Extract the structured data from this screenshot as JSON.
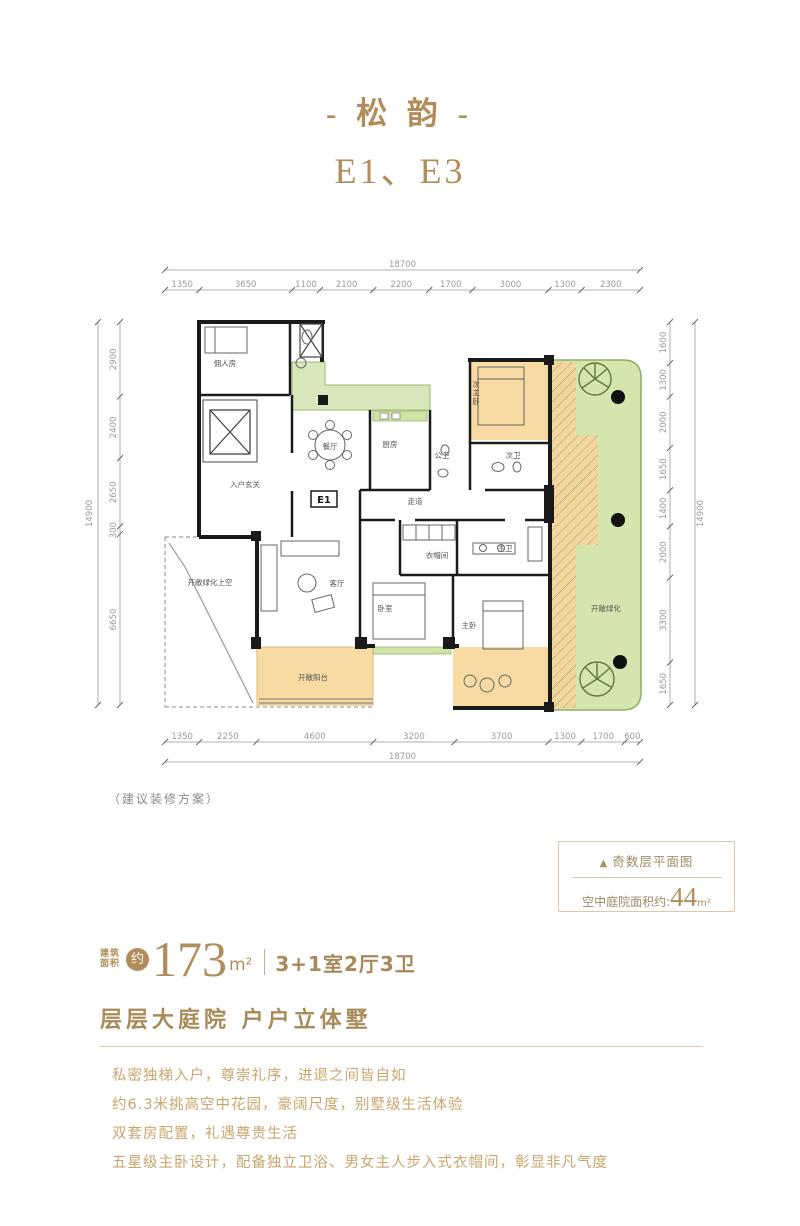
{
  "title": "- 松 韵 -",
  "subtitle": "E1、E3",
  "plan": {
    "unit_label": "E1",
    "note": "（建议装修方案）",
    "rooms": [
      {
        "label": "佣人房",
        "x": 140,
        "y": 121
      },
      {
        "label": "入户玄关",
        "x": 160,
        "y": 242
      },
      {
        "label": "餐厅",
        "x": 245,
        "y": 204
      },
      {
        "label": "厨房",
        "x": 305,
        "y": 202
      },
      {
        "label": "公卫",
        "x": 357,
        "y": 213
      },
      {
        "label": "走道",
        "x": 330,
        "y": 259
      },
      {
        "label": "次主卧",
        "x": 391,
        "y": 142,
        "v": true
      },
      {
        "label": "次卫",
        "x": 428,
        "y": 213
      },
      {
        "label": "主卫",
        "x": 420,
        "y": 306
      },
      {
        "label": "衣帽间",
        "x": 352,
        "y": 313
      },
      {
        "label": "卧室",
        "x": 300,
        "y": 366
      },
      {
        "label": "主卧",
        "x": 384,
        "y": 383
      },
      {
        "label": "客厅",
        "x": 252,
        "y": 341
      },
      {
        "label": "开敞绿化上空",
        "x": 125,
        "y": 340
      },
      {
        "label": "开敞阳台",
        "x": 228,
        "y": 435
      },
      {
        "label": "开敞绿化",
        "x": 521,
        "y": 366
      }
    ],
    "dims": {
      "top": {
        "total": "18700",
        "segments": [
          "1350",
          "3650",
          "1100",
          "2100",
          "2200",
          "1700",
          "3000",
          "1300",
          "2300"
        ]
      },
      "bottom": {
        "total": "18700",
        "segments": [
          "1350",
          "2250",
          "4600",
          "3200",
          "3700",
          "1300",
          "1700",
          "600"
        ]
      },
      "left": {
        "total": "14900",
        "segments": [
          "2900",
          "2400",
          "2650",
          "300",
          "6650"
        ]
      },
      "right": {
        "total": "14900",
        "segments": [
          "1600",
          "1300",
          "2000",
          "1650",
          "1400",
          "2000",
          "3300",
          "1650"
        ]
      }
    }
  },
  "info_box": {
    "triangle_icon": "▲",
    "floor_type": "奇数层平面图",
    "courtyard_prefix": "空中庭院面积约:",
    "courtyard_value": "44",
    "courtyard_unit": "m²"
  },
  "area": {
    "label_line1": "建筑",
    "label_line2": "面积",
    "approx": "约",
    "value": "173",
    "unit": "m²",
    "divider": "",
    "layout": "3+1室2厅3卫"
  },
  "slogan": "层层大庭院  户户立体墅",
  "description": [
    "私密独梯入户，尊崇礼序，进退之间皆自如",
    "约6.3米挑高空中花园，豪阔尺度，别墅级生活体验",
    "双套房配置，礼遇尊贵生活",
    "五星级主卧设计，配备独立卫浴、男女主人步入式衣帽间，彰显非凡气度"
  ],
  "colors": {
    "gold": "#b08d5a",
    "light_gold_text": "#c9a66b",
    "dim_text": "#9a9a9a",
    "green_fill": "#d4e6ae",
    "orange_fill": "#f7dba2",
    "wall": "#1a1a1a"
  }
}
